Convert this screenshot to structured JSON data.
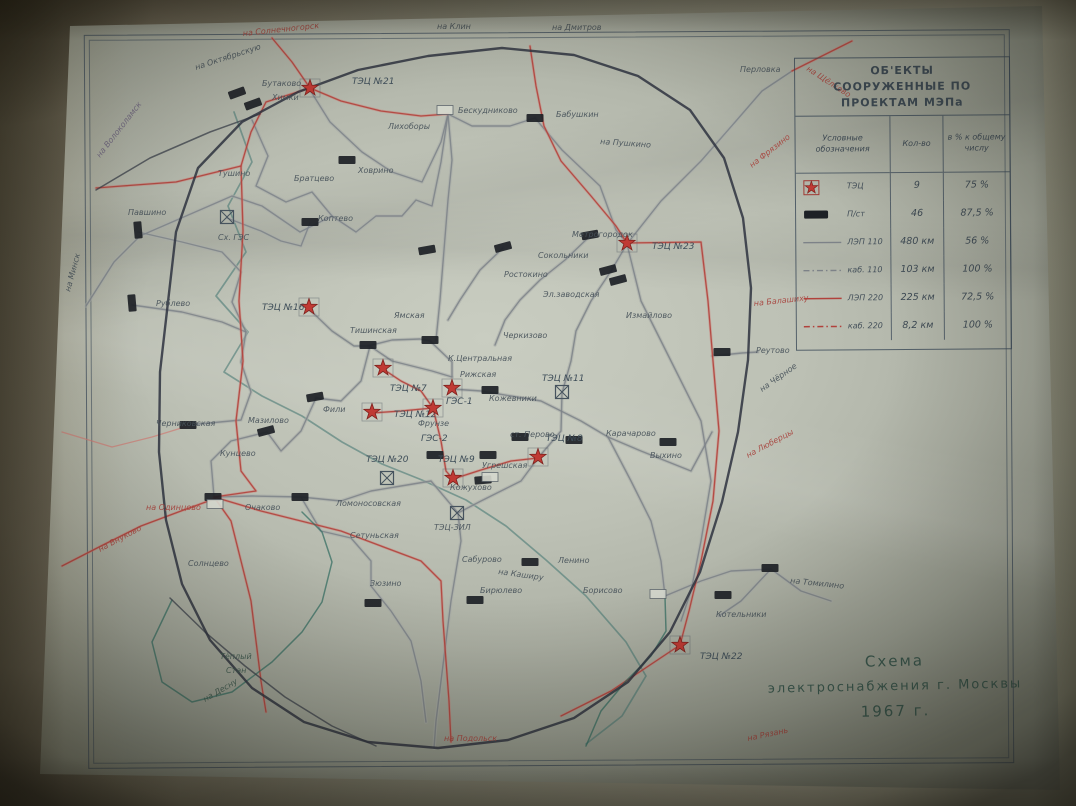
{
  "legend": {
    "title_line1": "ОБ'ЕКТЫ",
    "title_line2": "СООРУЖЕННЫЕ ПО ПРОЕКТАМ МЭПа",
    "col_symbol": "Условные обозначения",
    "col_qty": "Кол-во",
    "col_pct": "в % к общему числу",
    "rows": [
      {
        "symbol": "tec-star",
        "label": "ТЭЦ",
        "qty": "9",
        "pct": "75 %"
      },
      {
        "symbol": "substation-rect",
        "label": "П/ст",
        "qty": "46",
        "pct": "87,5 %"
      },
      {
        "symbol": "line-110",
        "label": "ЛЭП 110",
        "qty": "480 км",
        "pct": "56 %"
      },
      {
        "symbol": "cable-110",
        "label": "каб. 110",
        "qty": "103 км",
        "pct": "100 %"
      },
      {
        "symbol": "line-220",
        "label": "ЛЭП 220",
        "qty": "225 км",
        "pct": "72,5 %"
      },
      {
        "symbol": "cable-220",
        "label": "каб. 220",
        "qty": "8,2 км",
        "pct": "100 %"
      }
    ]
  },
  "title_block": {
    "line1": "Схема",
    "line2": "электроснабжения г. Москвы",
    "line3": "1967 г."
  },
  "colors": {
    "ink": "#3c4650",
    "red": "#b1423c",
    "red_light": "#cf7b74",
    "gray_line": "#7d8288",
    "gray_halo": "#a8aca8",
    "teal": "#2f6b60",
    "river": "#4a7a74",
    "label": "#47525a",
    "label_red": "#a8443e",
    "label_muted": "#6f6680",
    "star_fill": "#c03a34",
    "star_edge": "#7e221e",
    "box_fill": "#1d2126"
  },
  "map": {
    "ring_road": "168,302 176,232 198,168 242,122 298,92 358,70 428,56 502,48 574,55 638,76 690,110 724,158 743,218 751,288 748,360 738,432 722,502 700,572 670,632 628,682 574,718 508,740 438,748 368,742 304,722 252,688 210,640 182,584 166,520 159,452 160,372 168,302",
    "rails": [
      "170,598 205,632 245,666 285,697 332,726 376,746",
      "96,190 150,158 210,132 260,114"
    ],
    "river": "234,112 252,162 228,206 246,252 216,296 248,332 224,372 262,396 302,416 342,442 382,464 422,480 466,500 506,526 546,560 586,596 626,642 646,676 622,716 586,744",
    "lines_gray": [
      "86,306 114,262 140,236 186,216 232,196 262,206 300,232 332,216 356,232 376,216 402,216 416,200 432,206 441,162 448,114",
      "448,114 472,126 510,126 535,118",
      "535,118 562,150 600,186 616,230 627,243",
      "252,120 268,156 256,186 286,202 312,192 332,216",
      "310,90 330,122 362,152 392,172 422,182 441,142 448,114",
      "138,232 182,242 222,252 241,272 232,302 246,332 241,362 251,392 241,420 188,425",
      "132,305 182,312 222,322 246,332",
      "309,309 332,331 354,346 370,346 392,361 412,366 432,371 452,377",
      "370,346 361,381 341,401 316,398",
      "316,398 301,431 281,451 267,432 231,441 211,461 214,497",
      "214,497 252,496 301,497 341,501 371,491 401,486 431,481 458,513",
      "458,513 481,501 501,491 521,481 538,458",
      "538,458 561,431 562,393 571,361 576,331 591,301 611,271 627,244",
      "627,244 641,301 661,341 681,381 701,421 711,481 701,541 691,591 681,621",
      "452,389 481,391 511,396 541,401 561,411 581,421 608,437",
      "608,437 641,451 666,461 691,471 712,432",
      "712,356 742,353 758,352",
      "608,437 631,481 651,521 661,561 665,596",
      "665,596 701,581 731,571 771,569 801,591 831,601",
      "771,569 741,601 719,616",
      "458,513 461,541 456,571 451,601 446,641 441,681 436,721 434,748",
      "301,497 321,531 351,538 371,561 371,586 391,611 411,641 421,681 426,722",
      "627,244 661,201 701,161 736,121 762,91 792,71",
      "227,218 261,231 281,241 301,246 310,223",
      "368,346 392,340 420,339 430,341",
      "430,341 452,362 452,377",
      "448,114 452,160 448,200 444,250 440,300 436,340",
      "503,248 480,270 460,300 448,320",
      "590,236 565,260 540,280 520,300 505,320 495,345"
    ],
    "lines_pink": [
      "62,432 112,447 152,437 188,426"
    ],
    "lines_red": [
      "272,38 292,62 310,88",
      "310,88 266,102 251,132 241,166 176,182 122,186 96,188",
      "530,46 536,86 544,126 561,161 591,196 616,226 627,243",
      "627,243 701,242 708,301 713,361 719,431 713,501 701,561 689,611 680,645",
      "241,166 243,231 239,301 243,361 236,421 241,471 256,491 214,497",
      "214,497 261,511 301,521 341,531 381,546 421,561 441,581 443,621 446,661 449,701 451,742",
      "214,497 231,521 241,561 251,601 256,641 261,681 266,712",
      "62,566 101,546 141,526 181,511 214,499",
      "680,645 641,671 611,691 581,706 561,716",
      "792,71 822,56 852,41",
      "310,88 341,101 381,111 421,116 448,114",
      "383,369 401,381 421,391 433,408",
      "372,413 401,411 433,408",
      "433,408 441,441 446,471 453,479",
      "453,479 481,470 511,461 538,458"
    ],
    "lines_teal": [
      "586,746 601,711 626,681 651,656 666,631 665,597",
      "172,600 152,642 162,682 192,702 232,692 272,662 302,632 322,602 332,562 322,532 302,512"
    ],
    "stars": [
      {
        "x": 310,
        "y": 88,
        "label": "ТЭЦ №21",
        "lx": 352,
        "ly": 84
      },
      {
        "x": 627,
        "y": 243,
        "label": "ТЭЦ №23",
        "lx": 652,
        "ly": 249
      },
      {
        "x": 309,
        "y": 307,
        "label": "ТЭЦ №16",
        "lx": 262,
        "ly": 310
      },
      {
        "x": 383,
        "y": 368,
        "label": "ТЭЦ №7",
        "lx": 390,
        "ly": 391
      },
      {
        "x": 452,
        "y": 388,
        "label": "ГЭС-1",
        "lx": 446,
        "ly": 404
      },
      {
        "x": 372,
        "y": 412,
        "label": "ТЭЦ №12",
        "lx": 394,
        "ly": 417
      },
      {
        "x": 433,
        "y": 408,
        "label": "ГЭС-2",
        "lx": 421,
        "ly": 441
      },
      {
        "x": 453,
        "y": 478,
        "label": "ТЭЦ №9",
        "lx": 438,
        "ly": 462
      },
      {
        "x": 538,
        "y": 457,
        "label": "ТЭЦ №8",
        "lx": 546,
        "ly": 441
      },
      {
        "x": 680,
        "y": 645,
        "label": "ТЭЦ №22",
        "lx": 700,
        "ly": 659
      }
    ],
    "squares": [
      {
        "x": 227,
        "y": 217
      },
      {
        "x": 562,
        "y": 392,
        "label": "ТЭЦ №11",
        "lx": 542,
        "ly": 381
      },
      {
        "x": 387,
        "y": 478,
        "label": "ТЭЦ №20",
        "lx": 366,
        "ly": 462
      },
      {
        "x": 457,
        "y": 513
      }
    ],
    "substations": [
      [
        237,
        93,
        -20
      ],
      [
        253,
        104,
        -20
      ],
      [
        347,
        160,
        0
      ],
      [
        310,
        222,
        0
      ],
      [
        138,
        230,
        85
      ],
      [
        132,
        303,
        85
      ],
      [
        188,
        425,
        0
      ],
      [
        266,
        431,
        -15
      ],
      [
        213,
        497,
        0
      ],
      [
        300,
        497,
        0
      ],
      [
        315,
        397,
        -10
      ],
      [
        368,
        345,
        0
      ],
      [
        535,
        118,
        0
      ],
      [
        590,
        235,
        -10
      ],
      [
        503,
        247,
        -15
      ],
      [
        427,
        250,
        -10
      ],
      [
        608,
        270,
        -15
      ],
      [
        618,
        280,
        -15
      ],
      [
        430,
        340,
        0
      ],
      [
        490,
        390,
        0
      ],
      [
        435,
        455,
        0
      ],
      [
        488,
        455,
        0
      ],
      [
        483,
        480,
        -5
      ],
      [
        520,
        437,
        0
      ],
      [
        574,
        440,
        0
      ],
      [
        668,
        442,
        0
      ],
      [
        722,
        352,
        0
      ],
      [
        723,
        595,
        0
      ],
      [
        770,
        568,
        0
      ],
      [
        373,
        603,
        0
      ],
      [
        530,
        562,
        0
      ],
      [
        475,
        600,
        0
      ]
    ],
    "white_boxes": [
      [
        445,
        110
      ],
      [
        215,
        504
      ],
      [
        658,
        594
      ],
      [
        490,
        477
      ]
    ],
    "labels": [
      {
        "t": "на Солнечногорск",
        "x": 243,
        "y": 36,
        "c": "red",
        "r": -6
      },
      {
        "t": "на Клин",
        "x": 437,
        "y": 29
      },
      {
        "t": "на Дмитров",
        "x": 552,
        "y": 30
      },
      {
        "t": "на Октябрьскую",
        "x": 196,
        "y": 70,
        "r": -18
      },
      {
        "t": "Бутаково",
        "x": 262,
        "y": 86
      },
      {
        "t": "Химки",
        "x": 272,
        "y": 100
      },
      {
        "t": "на Волоколамск",
        "x": 100,
        "y": 158,
        "r": -52,
        "c": "muted"
      },
      {
        "t": "Перловка",
        "x": 740,
        "y": 72
      },
      {
        "t": "на Щёлково",
        "x": 806,
        "y": 70,
        "c": "red",
        "r": 33
      },
      {
        "t": "Тушино",
        "x": 218,
        "y": 176
      },
      {
        "t": "Братцево",
        "x": 294,
        "y": 181
      },
      {
        "t": "Ховрино",
        "x": 358,
        "y": 173
      },
      {
        "t": "Лихоборы",
        "x": 388,
        "y": 129
      },
      {
        "t": "Бескудниково",
        "x": 458,
        "y": 113
      },
      {
        "t": "Бабушкин",
        "x": 556,
        "y": 117
      },
      {
        "t": "на Пушкино",
        "x": 600,
        "y": 144,
        "r": 4
      },
      {
        "t": "на Фрязино",
        "x": 752,
        "y": 168,
        "c": "red",
        "r": -38
      },
      {
        "t": "Павшино",
        "x": 128,
        "y": 215
      },
      {
        "t": "Сх. ГЭС",
        "x": 218,
        "y": 240
      },
      {
        "t": "Коптево",
        "x": 318,
        "y": 221
      },
      {
        "t": "Метрогородок",
        "x": 572,
        "y": 237
      },
      {
        "t": "Сокольники",
        "x": 538,
        "y": 258
      },
      {
        "t": "Ростокино",
        "x": 504,
        "y": 277
      },
      {
        "t": "на Минск",
        "x": 70,
        "y": 292,
        "r": -75
      },
      {
        "t": "Рублево",
        "x": 156,
        "y": 306
      },
      {
        "t": "Эл.заводская",
        "x": 543,
        "y": 297
      },
      {
        "t": "Измайлово",
        "x": 626,
        "y": 318
      },
      {
        "t": "Черкизово",
        "x": 503,
        "y": 338
      },
      {
        "t": "на Балашиху",
        "x": 754,
        "y": 306,
        "c": "red",
        "r": -6
      },
      {
        "t": "Ямская",
        "x": 394,
        "y": 318
      },
      {
        "t": "Тишинская",
        "x": 350,
        "y": 333
      },
      {
        "t": "К.Центральная",
        "x": 448,
        "y": 361
      },
      {
        "t": "Реутово",
        "x": 756,
        "y": 353
      },
      {
        "t": "Рижская",
        "x": 460,
        "y": 377
      },
      {
        "t": "на Чёрное",
        "x": 762,
        "y": 392,
        "r": -35
      },
      {
        "t": "Черниковская",
        "x": 156,
        "y": 426
      },
      {
        "t": "Мазилово",
        "x": 248,
        "y": 423
      },
      {
        "t": "Фили",
        "x": 323,
        "y": 412
      },
      {
        "t": "Кожевники",
        "x": 489,
        "y": 401
      },
      {
        "t": "Фрунзе",
        "x": 418,
        "y": 426
      },
      {
        "t": "ст. Перово",
        "x": 510,
        "y": 437
      },
      {
        "t": "Карачарово",
        "x": 606,
        "y": 436
      },
      {
        "t": "Выхино",
        "x": 650,
        "y": 458
      },
      {
        "t": "на Люберцы",
        "x": 748,
        "y": 458,
        "c": "red",
        "r": -28
      },
      {
        "t": "Угрешская",
        "x": 482,
        "y": 468
      },
      {
        "t": "Кожухово",
        "x": 450,
        "y": 490
      },
      {
        "t": "Кунцево",
        "x": 220,
        "y": 456
      },
      {
        "t": "на Одинцово",
        "x": 146,
        "y": 510,
        "c": "red"
      },
      {
        "t": "Очаково",
        "x": 245,
        "y": 510
      },
      {
        "t": "Ломоносовская",
        "x": 336,
        "y": 506
      },
      {
        "t": "ТЭЦ-ЗИЛ",
        "x": 434,
        "y": 530
      },
      {
        "t": "на Внуково",
        "x": 100,
        "y": 552,
        "r": -28,
        "c": "red"
      },
      {
        "t": "Сетуньская",
        "x": 350,
        "y": 538
      },
      {
        "t": "Солнцево",
        "x": 188,
        "y": 566
      },
      {
        "t": "Ленино",
        "x": 558,
        "y": 563
      },
      {
        "t": "Сабурово",
        "x": 462,
        "y": 562
      },
      {
        "t": "на Каширу",
        "x": 498,
        "y": 574,
        "r": 8
      },
      {
        "t": "Зюзино",
        "x": 370,
        "y": 586
      },
      {
        "t": "Бирюлево",
        "x": 480,
        "y": 593
      },
      {
        "t": "Борисово",
        "x": 583,
        "y": 593
      },
      {
        "t": "Котельники",
        "x": 716,
        "y": 617
      },
      {
        "t": "на Томилино",
        "x": 790,
        "y": 583,
        "r": 6
      },
      {
        "t": "Тёплый",
        "x": 220,
        "y": 659,
        "c": "teal"
      },
      {
        "t": "Стан",
        "x": 226,
        "y": 673,
        "c": "teal"
      },
      {
        "t": "на Десну",
        "x": 205,
        "y": 702,
        "r": -30,
        "c": "teal"
      },
      {
        "t": "на Подольск",
        "x": 444,
        "y": 741,
        "c": "red"
      },
      {
        "t": "на Рязань",
        "x": 748,
        "y": 741,
        "c": "red",
        "r": -12
      }
    ]
  }
}
